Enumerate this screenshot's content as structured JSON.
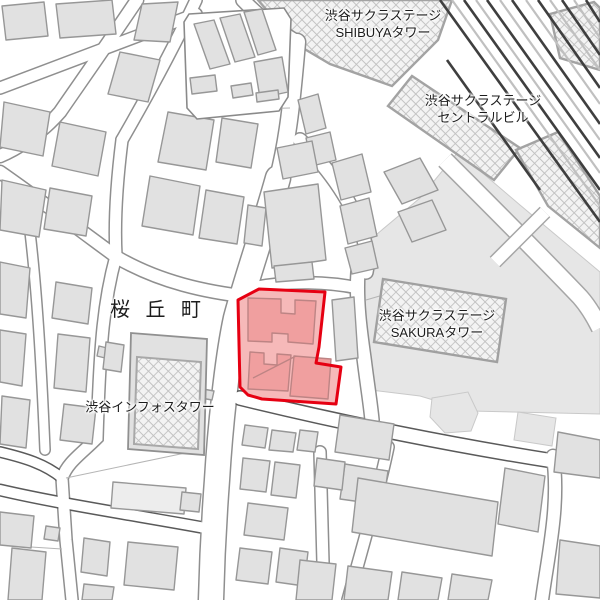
{
  "map": {
    "labels": {
      "shibuya_tower": {
        "line1": "渋谷サクラステージ",
        "line2": "SHIBUYAタワー"
      },
      "central_building": {
        "line1": "渋谷サクラステージ",
        "line2": "セントラルビル"
      },
      "sakura_tower": {
        "line1": "渋谷サクラステージ",
        "line2": "SAKURAタワー"
      },
      "district": {
        "text": "桜 丘 町"
      },
      "infos_tower": {
        "text": "渋谷インフォスタワー"
      }
    },
    "highlight": {
      "stroke": "#e60012",
      "fill": "#f6b9b9",
      "building_fill": "#f09f9f",
      "building_stroke": "#bd8484"
    },
    "colors": {
      "background": "#ffffff",
      "building": "#e1e1e1",
      "building_outline": "#979797",
      "ground": "#e6e6e6",
      "road_casing": "#8f8f8f",
      "road_casing_major": "#5a5a5a",
      "railway_dark": "#3f3f3f",
      "railway_light": "#c0c0c0",
      "hatch_line": "#c2c2c2",
      "hatch_bg": "#f3f3f3"
    }
  }
}
